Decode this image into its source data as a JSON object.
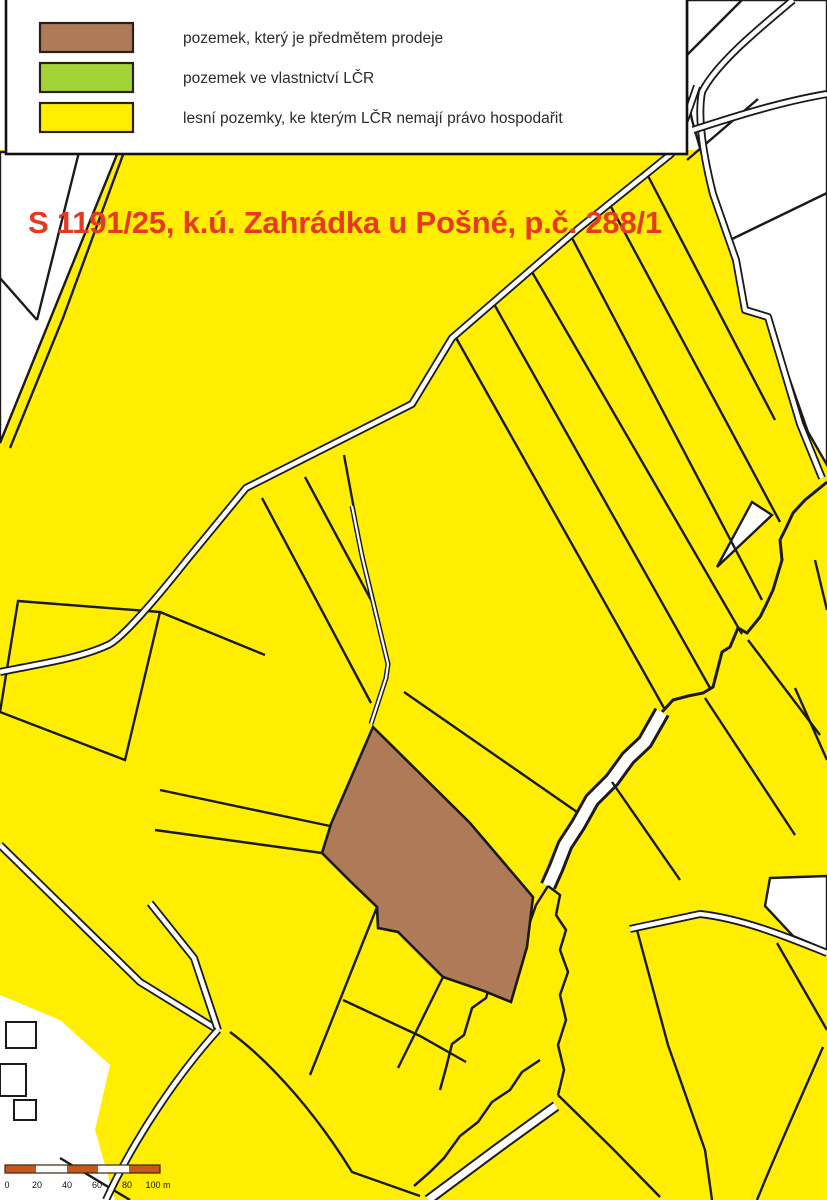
{
  "window": {
    "width": 827,
    "height": 1200
  },
  "colors": {
    "forest": "#ffee00",
    "sale_parcel": "#ae7a58",
    "lcr_owned": "#a2d437",
    "road_white": "#ffffff",
    "boundary_line": "#1a1a1a",
    "title": "#e8391f",
    "scale_bar": "#c7581c"
  },
  "title": {
    "text": "S 1191/25, k.ú. Zahrádka u Pošné, p.č. 288/1"
  },
  "legend": {
    "items": [
      {
        "id": "sale",
        "label": "pozemek, který je předmětem prodeje",
        "color": "#ae7a58"
      },
      {
        "id": "owned",
        "label": "pozemek ve vlastnictví LČR",
        "color": "#a2d437"
      },
      {
        "id": "forest",
        "label": "lesní pozemky, ke kterým LČR nemají právo hospodařit",
        "color": "#ffee00"
      }
    ]
  },
  "scale_bar": {
    "labels": [
      "0",
      "20",
      "40",
      "60",
      "80",
      "100 m"
    ]
  }
}
